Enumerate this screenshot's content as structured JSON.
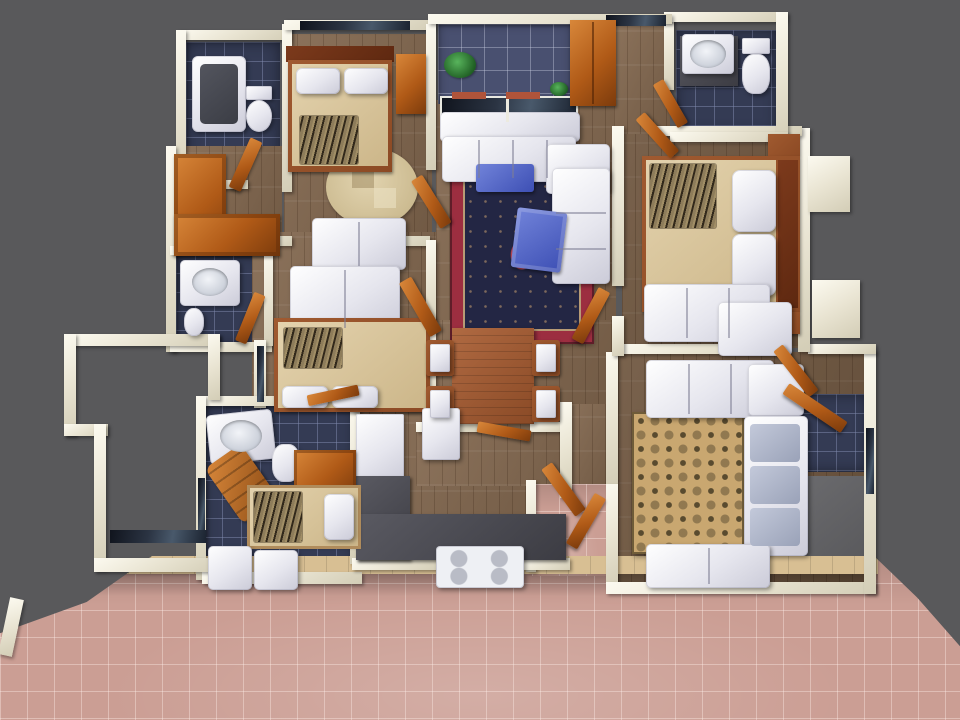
{
  "scene": {
    "type": "3d-floor-plan-render",
    "view": "top-down",
    "description": "3D rendered top-down floor plan of a multi-room apartment with white cream walls, wood floors, blue tiled bathrooms and a salmon tiled outdoor patio on dark gray background",
    "rooms": [
      {
        "id": "bathroom-1",
        "label": "Bathroom with bathtub and toilet",
        "floor": "blue-tile"
      },
      {
        "id": "master-bedroom",
        "label": "Bedroom with double bed and round rug",
        "floor": "wood"
      },
      {
        "id": "wardrobe-nook",
        "label": "Nook with L-shaped wooden wardrobe",
        "floor": "wood"
      },
      {
        "id": "bathroom-2",
        "label": "Bathroom with washbasin",
        "floor": "blue-tile"
      },
      {
        "id": "bedroom-2",
        "label": "Bedroom with double bed and two loveseats",
        "floor": "wood"
      },
      {
        "id": "balcony",
        "label": "Balcony with plants and glazed window",
        "floor": "blue-tile"
      },
      {
        "id": "living-room",
        "label": "Living room with sectional sofa and oriental rug",
        "floor": "wood"
      },
      {
        "id": "hallway",
        "label": "Hallway",
        "floor": "wood"
      },
      {
        "id": "bathroom-3",
        "label": "Bathroom with washbasin and toilet",
        "floor": "blue-tile"
      },
      {
        "id": "bedroom-3",
        "label": "Bedroom with double bed and sofa",
        "floor": "wood"
      },
      {
        "id": "dining-area",
        "label": "Dining area with table for four",
        "floor": "wood"
      },
      {
        "id": "kitchen",
        "label": "Kitchen with L-shaped counter and stove",
        "floor": "wood"
      },
      {
        "id": "utility-room",
        "label": "Utility / maid room with single bed and washer",
        "floor": "blue-tile"
      },
      {
        "id": "entry",
        "label": "Entry alcove with double doors",
        "floor": "patio-tile"
      },
      {
        "id": "family-room",
        "label": "Sitting room with sofas and damask rug",
        "floor": "wood"
      },
      {
        "id": "bathroom-4",
        "label": "Small bathroom",
        "floor": "blue-tile"
      },
      {
        "id": "storage-room",
        "label": "Storage room",
        "floor": "gray"
      },
      {
        "id": "courtyard",
        "label": "Open walled courtyard",
        "floor": "open"
      },
      {
        "id": "patio",
        "label": "Outdoor tiled patio",
        "floor": "salmon-tile"
      }
    ],
    "furniture": [
      "bathtub",
      "toilet",
      "washbasin",
      "double-bed",
      "single-bed",
      "pillows",
      "zebra-throw",
      "round-rug",
      "oriental-rug",
      "damask-rug",
      "sectional-sofa",
      "loveseat",
      "armchair",
      "ottoman",
      "bench",
      "coffee-table",
      "dining-table",
      "dining-chair",
      "wardrobe",
      "cabinet",
      "dresser",
      "nightstand",
      "fridge",
      "stove",
      "kitchen-counter",
      "washer",
      "laundry-basket",
      "plant",
      "door",
      "window"
    ]
  },
  "colors": {
    "bg": "#59595b",
    "wall": "#e9e4d2",
    "wood": "#83684f",
    "tileBlue": "#343b54",
    "balconyTile": "#495070",
    "patioBase": "#cb9e94",
    "patioBorder": "#d8bf93",
    "orange": "#b05a17",
    "orangeHi": "#d8873a",
    "blanketTan": "#e4d3ae",
    "bedFrame": "#8c4a24",
    "rugRedBorder": "#9c2e40",
    "rugRedField": "#232644",
    "rugTanBase": "#c9a770",
    "rugTanPattern": "#594b2f",
    "tableBlue": "#3d4fb4",
    "counterDark": "#3c3c43",
    "plantGreen": "#1e5c22",
    "grayFloor": "#6b6b6e"
  }
}
